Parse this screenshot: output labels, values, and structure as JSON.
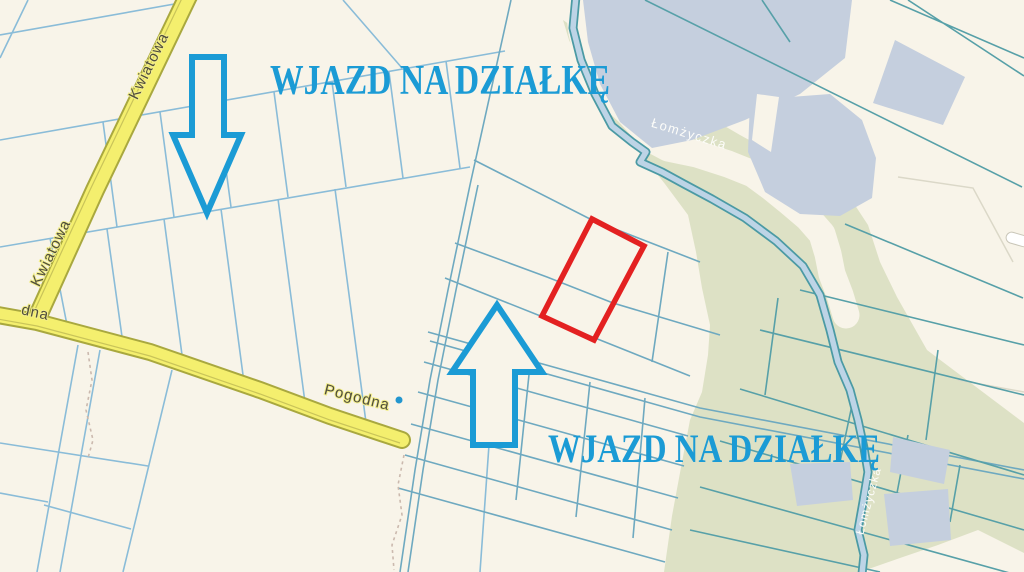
{
  "map": {
    "annotations": {
      "entrance_label_top": "WJAZD NA DZIAŁKĘ",
      "entrance_label_bottom": "WJAZD NA DZIAŁKĘ"
    },
    "streets": {
      "kwiatowa_upper": "Kwiatowa",
      "kwiatowa_lower": "Kwiatowa",
      "pogodna": "Pogodna",
      "left_edge_partial": "dna"
    },
    "water": {
      "river_label": "Łomżyczka",
      "river_label_lower": "Łomżyczka"
    },
    "colors": {
      "background": "#f8f4e9",
      "green_area": "#dde1c5",
      "water": "#c5cfde",
      "road_fill": "#f4ef6e",
      "road_casing": "#a9a83f",
      "parcel_line_blue": "#8abcd8",
      "parcel_line_fan": "#6ea9c0",
      "parcel_line_teal": "#57a0a8",
      "stream_fill": "#bdd4e6",
      "stream_edge": "#4b9aa4",
      "annotation_blue": "#1b9bd5",
      "highlight_red": "#e32121",
      "street_label": "#4f4d3d"
    }
  }
}
